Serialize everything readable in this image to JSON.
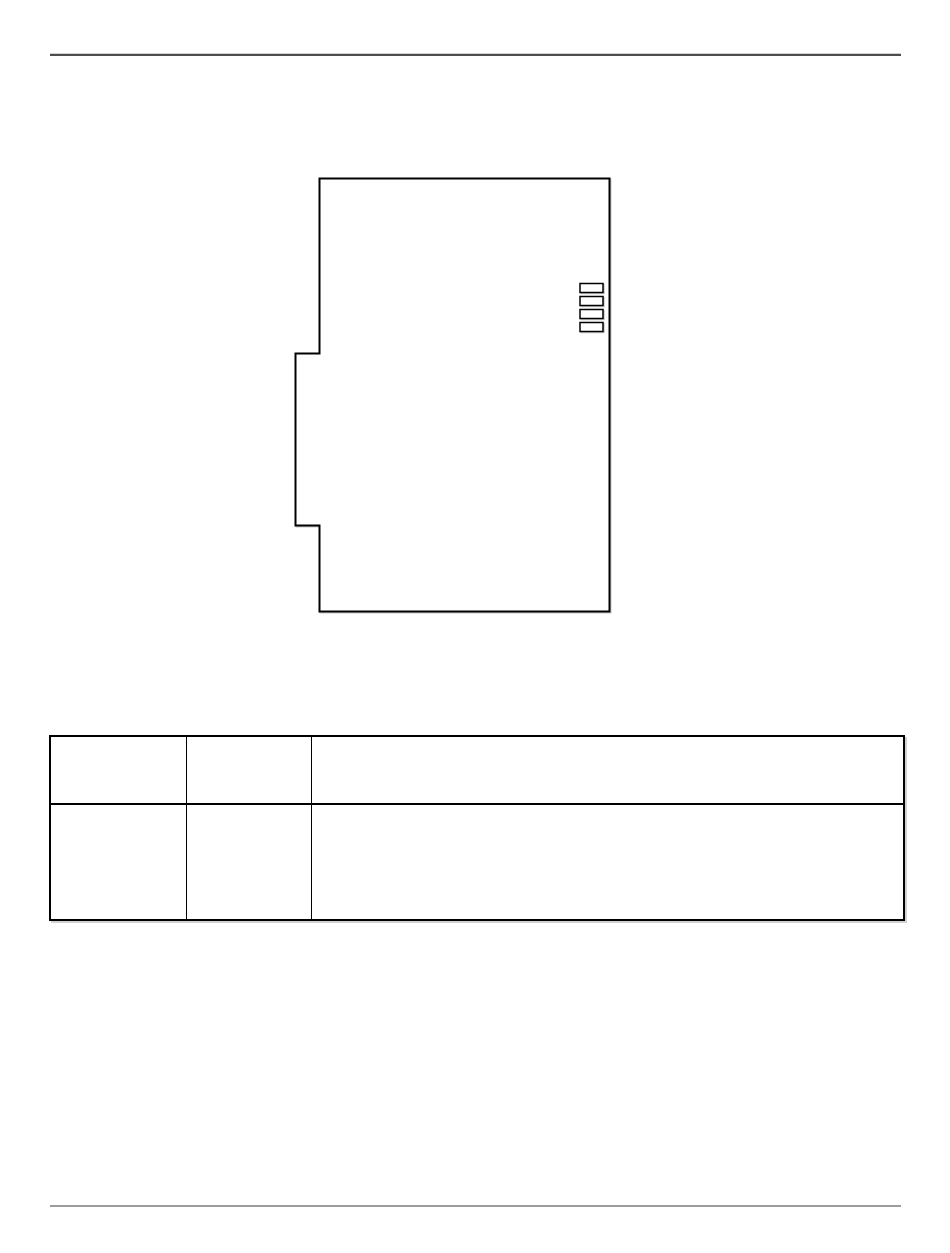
{
  "page": {
    "background_color": "#ffffff",
    "header_rule_color": "#4d4d4d",
    "footer_rule_color": "#9c9c9c"
  },
  "figure": {
    "name": "module-outline-diagram",
    "stroke_color": "#000000",
    "fill_color": "#ffffff",
    "led_count": 4
  },
  "table": {
    "column_count": 3,
    "row_count": 2,
    "border_color": "#000000",
    "rows": [
      {
        "cells": [
          "",
          "",
          ""
        ]
      },
      {
        "cells": [
          "",
          "",
          ""
        ]
      }
    ]
  }
}
